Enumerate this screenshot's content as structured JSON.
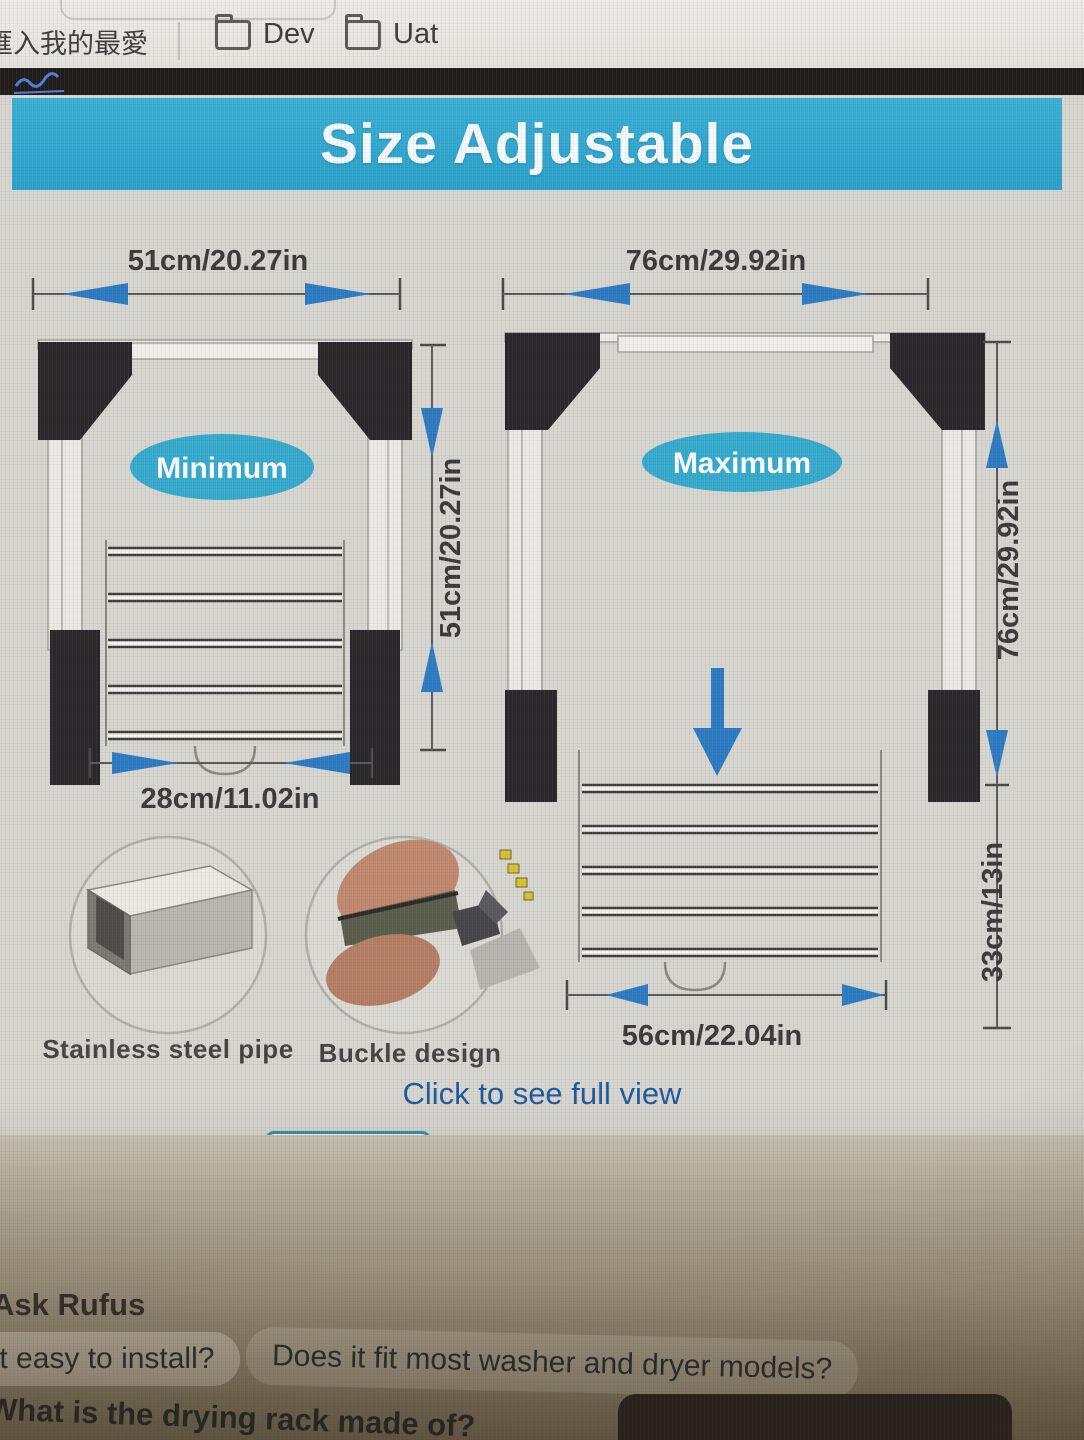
{
  "browser": {
    "import_bookmark": "匯入我的最愛",
    "folder_dev": "Dev",
    "folder_uat": "Uat"
  },
  "banner": {
    "title": "Size Adjustable"
  },
  "diagram": {
    "min_label": "Minimum",
    "max_label": "Maximum",
    "min_top_width": "51cm/20.27in",
    "max_top_width": "76cm/29.92in",
    "min_height": "51cm/20.27in",
    "max_height": "76cm/29.92in",
    "rack_drop_height": "33cm/13in",
    "min_bottom_width": "28cm/11.02in",
    "max_bottom_width": "56cm/22.04in"
  },
  "features": {
    "pipe": "Stainless steel pipe",
    "buckle": "Buckle design"
  },
  "links": {
    "full_view": "Click to see full view"
  },
  "rufus": {
    "heading": "Ask Rufus",
    "q_install": "Is it easy to install?",
    "q_fit": "Does it fit most washer and dryer models?",
    "q_material": "What is the drying rack made of?"
  },
  "colors": {
    "banner_cyan": "#35aad2",
    "dimension_blue": "#2e7cc3",
    "ellipse_cyan": "#36abce",
    "link_blue": "#1e5b9e",
    "selected_thumb_border": "#2f93ad"
  }
}
